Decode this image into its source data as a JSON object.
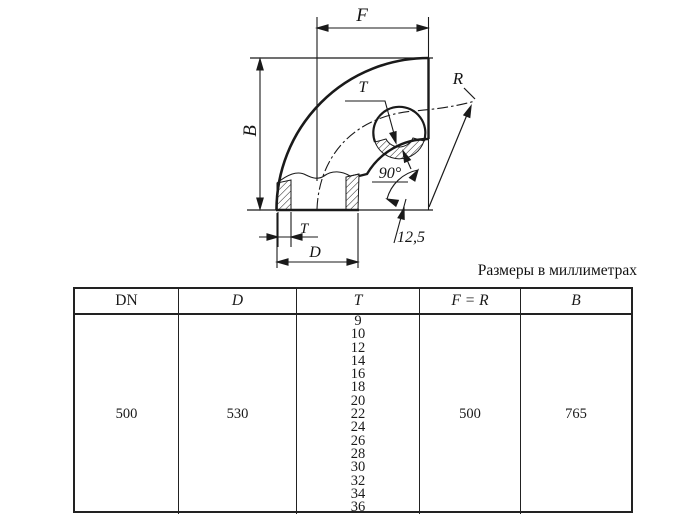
{
  "note": "Размеры в миллиметрах",
  "drawing": {
    "labels": {
      "f": "F",
      "b": "B",
      "t_section": "T",
      "r": "R",
      "angle": "90°",
      "bevel": "12,5",
      "t_dim": "T",
      "d": "D"
    }
  },
  "table": {
    "headers": [
      "DN",
      "D",
      "T",
      "F = R",
      "B"
    ],
    "values": {
      "dn": "500",
      "d": "530",
      "t_list": [
        "9",
        "10",
        "12",
        "14",
        "16",
        "18",
        "20",
        "22",
        "24",
        "26",
        "28",
        "30",
        "32",
        "34",
        "36"
      ],
      "f_r": "500",
      "b": "765"
    }
  }
}
